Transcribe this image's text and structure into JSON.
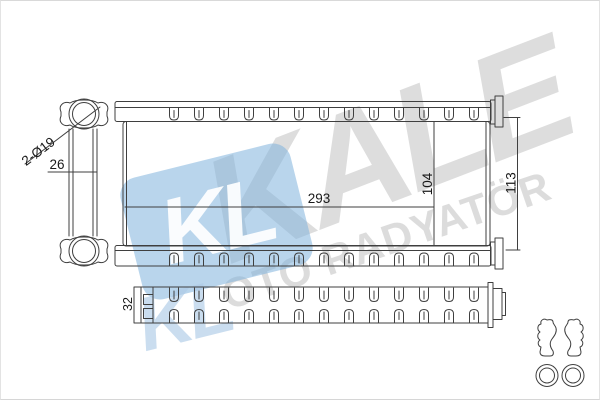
{
  "watermark": {
    "brand": "KALE",
    "subtitle": "OTO RADYATÖR",
    "monogram": "KL",
    "monogram_reflection": "KL",
    "brand_gray": "#c9c9c9",
    "logo_blue": "#7fb2dd"
  },
  "drawing": {
    "line_color": "#3f3f3f",
    "dimensions": {
      "port_diameter": "2-Ø19",
      "port_spacing": "26",
      "core_width": "293",
      "core_height": "104",
      "total_height": "113",
      "core_depth": "32"
    }
  }
}
